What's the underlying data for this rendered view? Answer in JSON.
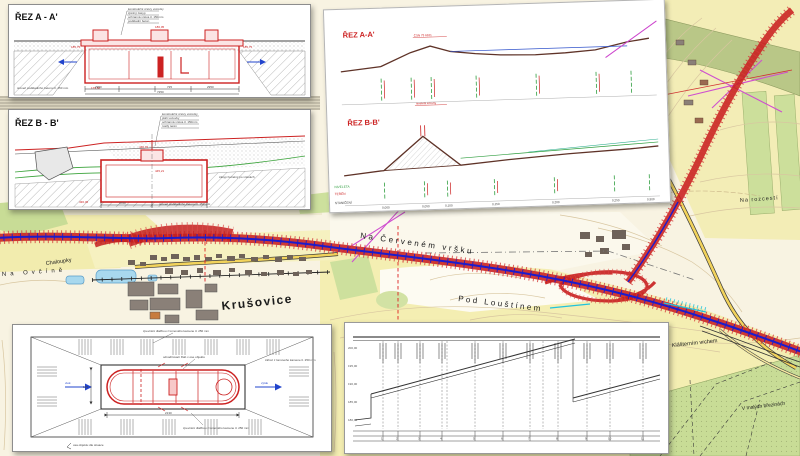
{
  "map": {
    "labels": {
      "town": "Krušovice",
      "hill1": "Na Červeném vršku",
      "hill2": "Pod Louštínem",
      "crossroads": "Na rozcestí",
      "chaloupky": "Chaloupky",
      "ovcin": "Na Ovčíně",
      "klasterni": "Klášterním vrchem",
      "breziny": "V malých březinách"
    },
    "colors": {
      "alignment_red": "#c81f1f",
      "centerline_blue": "#1c1ccc",
      "utility_magenta": "#cf4fcf",
      "utility_cyan": "#22c3dc",
      "road_yellow": "#f2d35c",
      "field_yellow": "#f4eeb2",
      "forest_green": "#cbdd9b",
      "water_blue": "#a8d8ee",
      "contour_brown": "#d8c6a0"
    }
  },
  "panels": {
    "section_a": {
      "title": "ŘEZ A - A'",
      "notes": [
        "konstrukční vrstvy vozovky",
        "zpětný zásyp",
        "ochranná vrstva tl. 150mm",
        "podkladní beton"
      ],
      "note_bottom": "úroveň podkladního betonu tl. 150 mm",
      "elev_left": "185,75",
      "elev_right": "185,75",
      "elev_top": "186,05",
      "elev_bottom": "179,80",
      "dims": [
        "295",
        "2950",
        "725",
        "2950",
        "295"
      ],
      "dim_total": "7250"
    },
    "section_b": {
      "title": "ŘEZ B - B'",
      "notes": [
        "konstrukční vrstvy vozovky",
        "pláň vozovky",
        "ochranná vrstva tl. 150mm",
        "rostlý terén"
      ],
      "note_box": "zásyp hutněný po vrstvách",
      "note_bottom": "úroveň podkladního betonu tl. 150 mm",
      "elev_top": "446,72",
      "elev_mid": "445,21",
      "elev_bottom": "436,45",
      "dims": [
        "170",
        "4700",
        "170"
      ]
    },
    "profiles": {
      "title_a": "ŘEZ A-A'",
      "title_b": "ŘEZ B-B'",
      "row_labels": [
        "NIVELETA",
        "TERÉN",
        "STANIČENÍ"
      ],
      "stations": [
        "0,000",
        "0,050",
        "0,100",
        "0,150",
        "0,200",
        "0,250",
        "0,300"
      ]
    },
    "plan": {
      "notes_top": "zpevnění dlažbou z lomového kamene tl. 250 mm",
      "notes_mid": "odvodňovací žlab v ose objektu",
      "notes_right": "zához z lomového kamene tl. 250 mm",
      "notes_bottom": "zpevnění dlažbou z lomového kamene tl. 250 mm",
      "notes_corner": "osa objektu dle situace",
      "label_left": "vtok",
      "label_right": "výtok",
      "dims": [
        "60",
        "2130",
        "60"
      ],
      "dim_left": "125"
    },
    "profile_chart": {
      "left_labels": [
        "200,00",
        "195,00",
        "190,00",
        "185,00",
        "180,00"
      ],
      "stations": [
        "1",
        "2",
        "3",
        "4",
        "5",
        "6",
        "7",
        "8",
        "9",
        "10",
        "11",
        "12",
        "13"
      ]
    }
  }
}
